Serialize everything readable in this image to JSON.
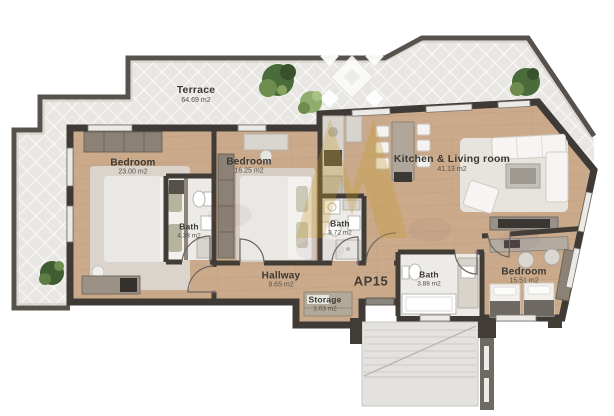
{
  "plan": {
    "unit_label": "AP15",
    "rooms": [
      {
        "id": "terrace",
        "name": "Terrace",
        "area": "64.69 m2"
      },
      {
        "id": "bedroom-left",
        "name": "Bedroom",
        "area": "23.00 m2"
      },
      {
        "id": "bedroom-middle",
        "name": "Bedroom",
        "area": "16.25 m2"
      },
      {
        "id": "bath-left",
        "name": "Bath",
        "area": "4.38 m2"
      },
      {
        "id": "bath-middle",
        "name": "Bath",
        "area": "3.72 m2"
      },
      {
        "id": "kitchen-living",
        "name": "Kitchen & Living room",
        "area": "41.13 m2"
      },
      {
        "id": "hallway",
        "name": "Hallway",
        "area": "9.65 m2"
      },
      {
        "id": "storage",
        "name": "Storage",
        "area": "1.03 m2"
      },
      {
        "id": "bath-right",
        "name": "Bath",
        "area": "3.88 m2"
      },
      {
        "id": "bedroom-right",
        "name": "Bedroom",
        "area": "15.51 m2"
      }
    ],
    "colors": {
      "wall": "#413c36",
      "wood_floor": "#cbaa8b",
      "tile_floor": "#e8e7e3",
      "bath_floor": "#ecebe8",
      "watermark_gold": "#c79d2a"
    }
  }
}
